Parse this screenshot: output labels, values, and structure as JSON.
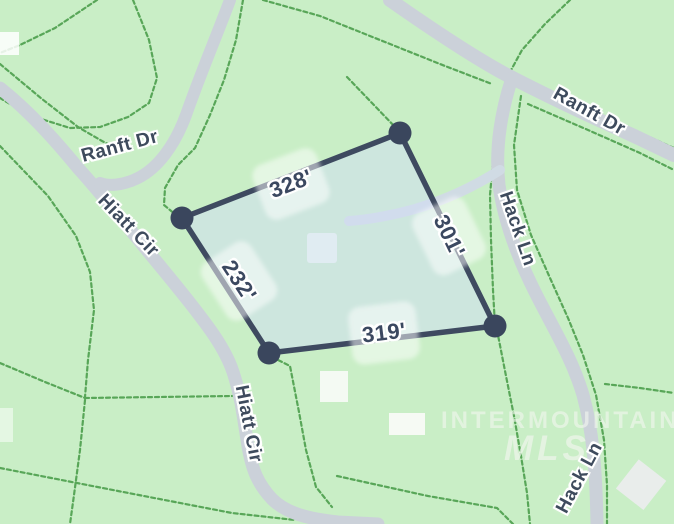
{
  "map": {
    "streets": {
      "ranft_west": "Ranft Dr",
      "ranft_northeast": "Ranft Dr",
      "hiatt_upper": "Hiatt Cir",
      "hiatt_lower": "Hiatt Cir",
      "hack_upper": "Hack Ln",
      "hack_lower": "Hack Ln"
    },
    "lot": {
      "side_top": "328'",
      "side_left": "232'",
      "side_bottom": "319'",
      "side_right": "301'"
    },
    "watermark": {
      "line1": "INTERMOUNTAIN",
      "line2": "MLS"
    },
    "colors": {
      "background": "#c9eec6",
      "road": "#cbd1d9",
      "driveway": "#d0dbe4",
      "parcel_line": "#58a658",
      "lot_fill": "rgba(210,221,246,0.5)",
      "lot_border": "#3e4a60",
      "lot_corner_dot": "#3a465d",
      "dimension_text": "#3b4860",
      "street_text": "#3e4b5d"
    }
  }
}
